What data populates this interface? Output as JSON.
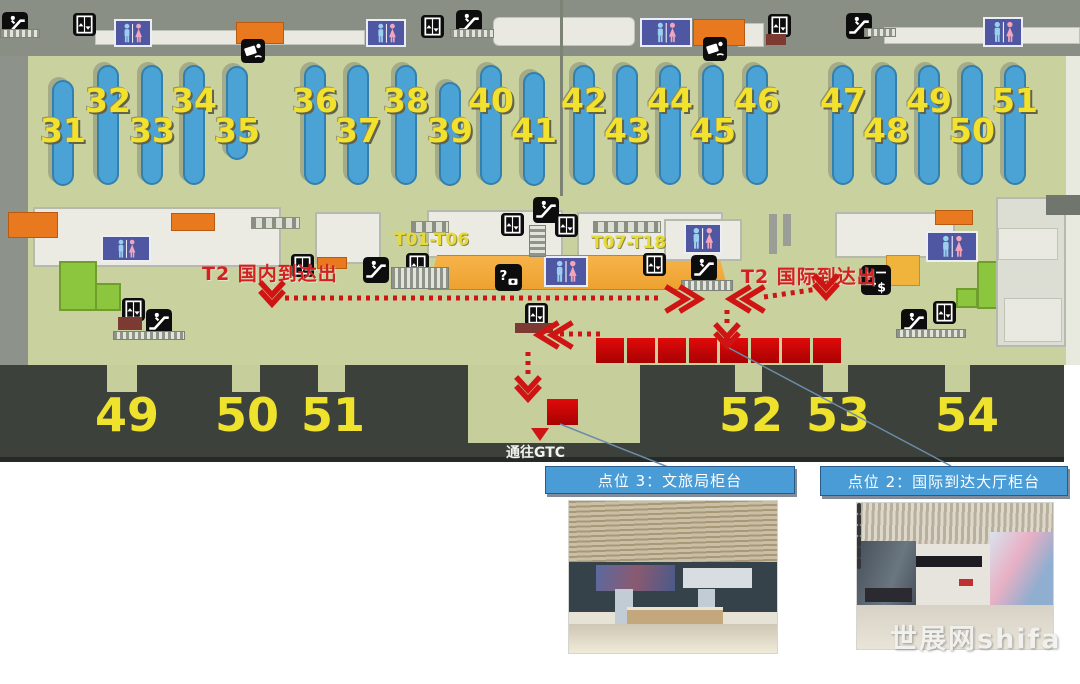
{
  "colors": {
    "floor": "#c9d19e",
    "carousel_blue": "#4ba2d4",
    "number_yellow": "#f2e22e",
    "route_red": "#cf1414",
    "callout_blue": "#4a9cd6",
    "band_dark": "#3d413c"
  },
  "map": {
    "zone_labels": [
      {
        "text": "T01-T06",
        "x": 394,
        "y": 230
      },
      {
        "text": "T07-T18",
        "x": 591,
        "y": 233
      }
    ],
    "arrival_labels": [
      {
        "text": "T2 国内到达出",
        "x": 202,
        "y": 259
      },
      {
        "text": "T2 国际到达出",
        "x": 741,
        "y": 262
      }
    ],
    "gtc_label": {
      "text": "通往GTC",
      "x": 506,
      "y": 442
    },
    "carousels": [
      {
        "num": "31",
        "x": 63,
        "row": "low",
        "y": 80,
        "h": 106
      },
      {
        "num": "32",
        "x": 108,
        "row": "up"
      },
      {
        "num": "33",
        "x": 152,
        "row": "low"
      },
      {
        "num": "34",
        "x": 194,
        "row": "up"
      },
      {
        "num": "35",
        "x": 237,
        "row": "low",
        "y": 66,
        "h": 94
      },
      {
        "num": "36",
        "x": 315,
        "row": "up"
      },
      {
        "num": "37",
        "x": 358,
        "row": "low"
      },
      {
        "num": "38",
        "x": 406,
        "row": "up"
      },
      {
        "num": "39",
        "x": 450,
        "row": "low",
        "y": 82,
        "h": 104
      },
      {
        "num": "40",
        "x": 491,
        "row": "up"
      },
      {
        "num": "41",
        "x": 534,
        "row": "low",
        "y": 72,
        "h": 114
      },
      {
        "num": "42",
        "x": 584,
        "row": "up"
      },
      {
        "num": "43",
        "x": 627,
        "row": "low"
      },
      {
        "num": "44",
        "x": 670,
        "row": "up"
      },
      {
        "num": "45",
        "x": 713,
        "row": "low"
      },
      {
        "num": "46",
        "x": 757,
        "row": "up"
      },
      {
        "num": "47",
        "x": 843,
        "row": "up"
      },
      {
        "num": "48",
        "x": 886,
        "row": "low"
      },
      {
        "num": "49",
        "x": 929,
        "row": "up"
      },
      {
        "num": "50",
        "x": 972,
        "row": "low"
      },
      {
        "num": "51",
        "x": 1015,
        "row": "up"
      }
    ],
    "doors": [
      {
        "num": "49",
        "cx": 127,
        "gx": 107,
        "gw": 30
      },
      {
        "num": "50",
        "cx": 247,
        "gx": 232,
        "gw": 28
      },
      {
        "num": "51",
        "cx": 333,
        "gx": 318,
        "gw": 27
      },
      {
        "num": "52",
        "cx": 751,
        "gx": 735,
        "gw": 27
      },
      {
        "num": "53",
        "cx": 838,
        "gx": 823,
        "gw": 25
      },
      {
        "num": "54",
        "cx": 967,
        "gx": 945,
        "gw": 25
      }
    ],
    "icons": [
      {
        "type": "escalator",
        "x": 2,
        "y": 12
      },
      {
        "type": "escalator",
        "x": 456,
        "y": 10
      },
      {
        "type": "escalator",
        "x": 846,
        "y": 13
      },
      {
        "type": "escalator",
        "x": 533,
        "y": 197
      },
      {
        "type": "escalator",
        "x": 363,
        "y": 257
      },
      {
        "type": "escalator",
        "x": 691,
        "y": 255
      },
      {
        "type": "escalator",
        "x": 146,
        "y": 309
      },
      {
        "type": "escalator",
        "x": 901,
        "y": 309
      },
      {
        "type": "elevator",
        "x": 73,
        "y": 11
      },
      {
        "type": "elevator",
        "x": 421,
        "y": 13
      },
      {
        "type": "elevator",
        "x": 768,
        "y": 12
      },
      {
        "type": "elevator",
        "x": 291,
        "y": 252
      },
      {
        "type": "elevator",
        "x": 406,
        "y": 251
      },
      {
        "type": "elevator",
        "x": 501,
        "y": 211
      },
      {
        "type": "elevator",
        "x": 555,
        "y": 212
      },
      {
        "type": "elevator",
        "x": 643,
        "y": 251
      },
      {
        "type": "elevator",
        "x": 122,
        "y": 296
      },
      {
        "type": "elevator",
        "x": 525,
        "y": 301
      },
      {
        "type": "elevator",
        "x": 933,
        "y": 299
      },
      {
        "type": "restroom",
        "x": 114,
        "y": 19,
        "w": 38,
        "h": 28
      },
      {
        "type": "restroom",
        "x": 366,
        "y": 19,
        "w": 40,
        "h": 28
      },
      {
        "type": "restroom",
        "x": 640,
        "y": 18,
        "w": 52,
        "h": 29
      },
      {
        "type": "restroom",
        "x": 983,
        "y": 17,
        "w": 40,
        "h": 30
      },
      {
        "type": "restroom",
        "x": 101,
        "y": 235,
        "w": 50,
        "h": 27
      },
      {
        "type": "restroom",
        "x": 544,
        "y": 256,
        "w": 44,
        "h": 31
      },
      {
        "type": "restroom",
        "x": 684,
        "y": 223,
        "w": 38,
        "h": 31
      },
      {
        "type": "restroom",
        "x": 926,
        "y": 231,
        "w": 52,
        "h": 31
      },
      {
        "type": "customs-check",
        "x": 241,
        "y": 39
      },
      {
        "type": "customs-check",
        "x": 703,
        "y": 37
      },
      {
        "type": "information",
        "x": 495,
        "y": 264
      },
      {
        "type": "currency-exchange",
        "x": 861,
        "y": 264
      },
      {
        "type": "walkway",
        "x": 0,
        "y": 29,
        "w": 40,
        "h": 9
      },
      {
        "type": "walkway",
        "x": 450,
        "y": 29,
        "w": 44,
        "h": 9
      },
      {
        "type": "walkway",
        "x": 864,
        "y": 28,
        "w": 32,
        "h": 9
      },
      {
        "type": "walkway",
        "x": 113,
        "y": 331,
        "w": 72,
        "h": 9
      },
      {
        "type": "walkway",
        "x": 391,
        "y": 267,
        "w": 58,
        "h": 22
      },
      {
        "type": "walkway",
        "x": 681,
        "y": 280,
        "w": 52,
        "h": 11
      },
      {
        "type": "walkway",
        "x": 896,
        "y": 329,
        "w": 70,
        "h": 9
      },
      {
        "type": "walkway-vertical",
        "x": 529,
        "y": 225,
        "w": 17,
        "h": 32
      },
      {
        "type": "stairs",
        "x": 251,
        "y": 217,
        "w": 49,
        "h": 12
      },
      {
        "type": "stairs",
        "x": 411,
        "y": 221,
        "w": 38,
        "h": 12
      },
      {
        "type": "stairs",
        "x": 593,
        "y": 221,
        "w": 68,
        "h": 12
      },
      {
        "type": "platform",
        "x": 118,
        "y": 317,
        "w": 24,
        "h": 13
      },
      {
        "type": "platform",
        "x": 515,
        "y": 323,
        "w": 38,
        "h": 10
      },
      {
        "type": "platform",
        "x": 766,
        "y": 34,
        "w": 20,
        "h": 11
      }
    ],
    "counter_positions": {
      "red_squares_count": 8,
      "single_square": 1
    }
  },
  "callouts": [
    {
      "label": "点位 3：文旅局柜台"
    },
    {
      "label": "点位 2：国际到达大厅柜台"
    }
  ],
  "watermark": "世展网shifa"
}
